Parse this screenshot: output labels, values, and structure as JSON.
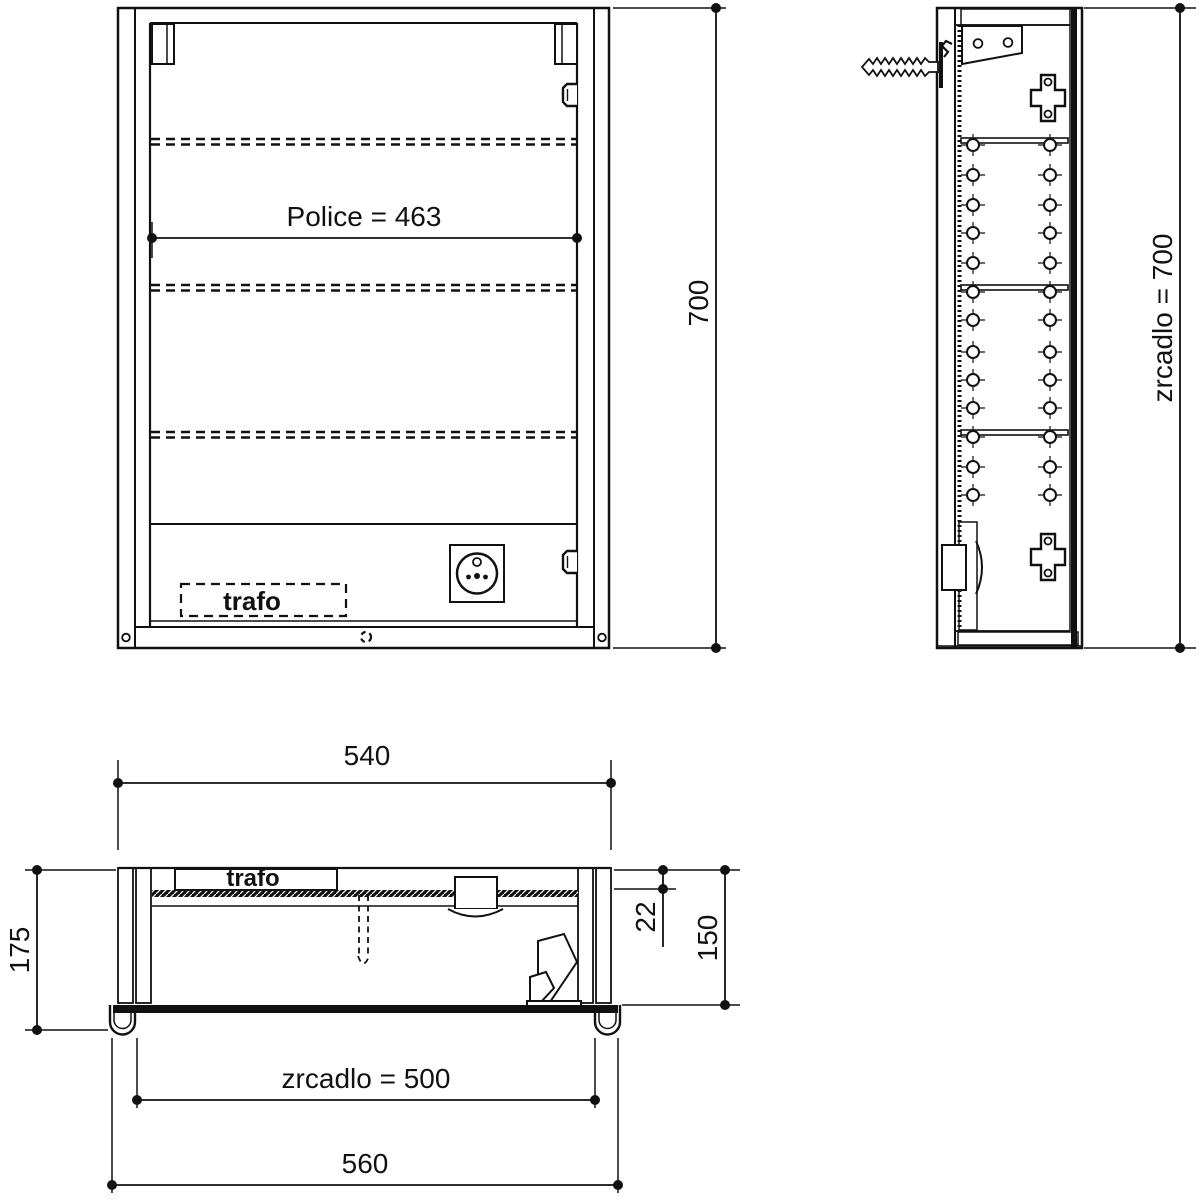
{
  "front_view": {
    "shelf_dim_label": "Police = 463",
    "trafo_label": "trafo",
    "height_dim_label": "700"
  },
  "side_view": {
    "mirror_height_label": "zrcadlo = 700"
  },
  "plan_view": {
    "top_width_label": "540",
    "depth_label": "175",
    "top_thickness_label": "22",
    "inner_depth_label": "150",
    "trafo_label": "trafo",
    "mirror_width_label": "zrcadlo = 500",
    "bottom_width_label": "560"
  },
  "colors": {
    "line": "#111111",
    "background": "#ffffff"
  }
}
